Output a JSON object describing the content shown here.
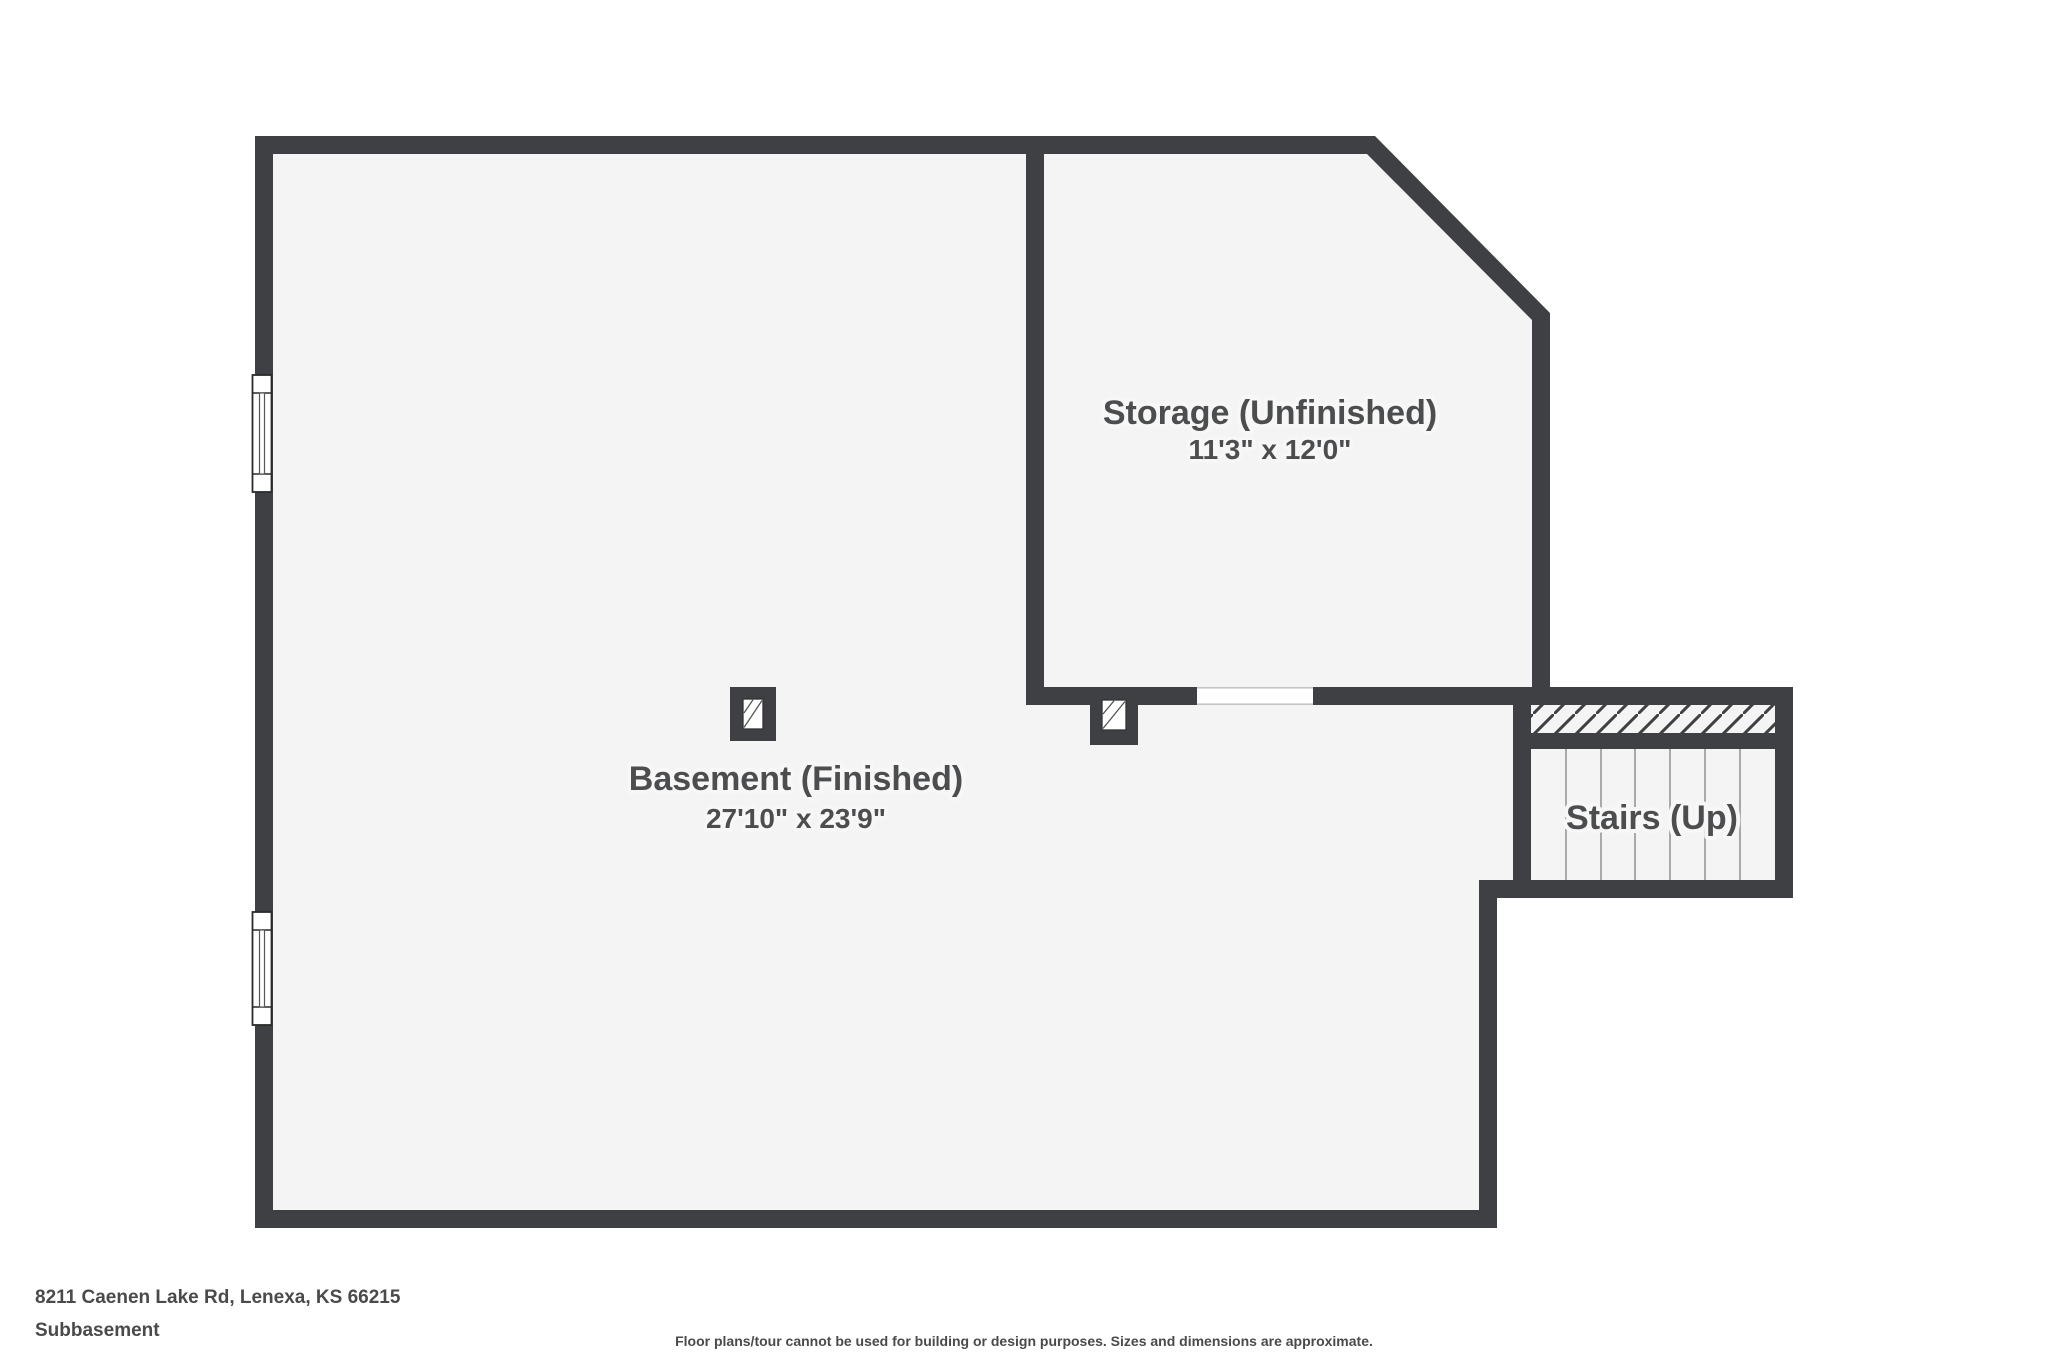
{
  "plan": {
    "colors": {
      "wall": "#3e4043",
      "floor": "#f4f4f5",
      "label": "#4c4d4f",
      "tread_line": "#a9a9a9",
      "opening_edge": "#c6c6c6"
    },
    "rooms": [
      {
        "name": "Basement (Finished)",
        "dimensions": "27'10\" x 23'9\""
      },
      {
        "name": "Storage (Unfinished)",
        "dimensions": "11'3\" x 12'0\""
      },
      {
        "name": "Stairs (Up)",
        "dimensions": ""
      }
    ]
  },
  "footer": {
    "address": "8211 Caenen Lake Rd, Lenexa, KS 66215",
    "floor_name": "Subbasement",
    "disclaimer": "Floor plans/tour cannot be used for building or design purposes. Sizes and dimensions are approximate."
  }
}
